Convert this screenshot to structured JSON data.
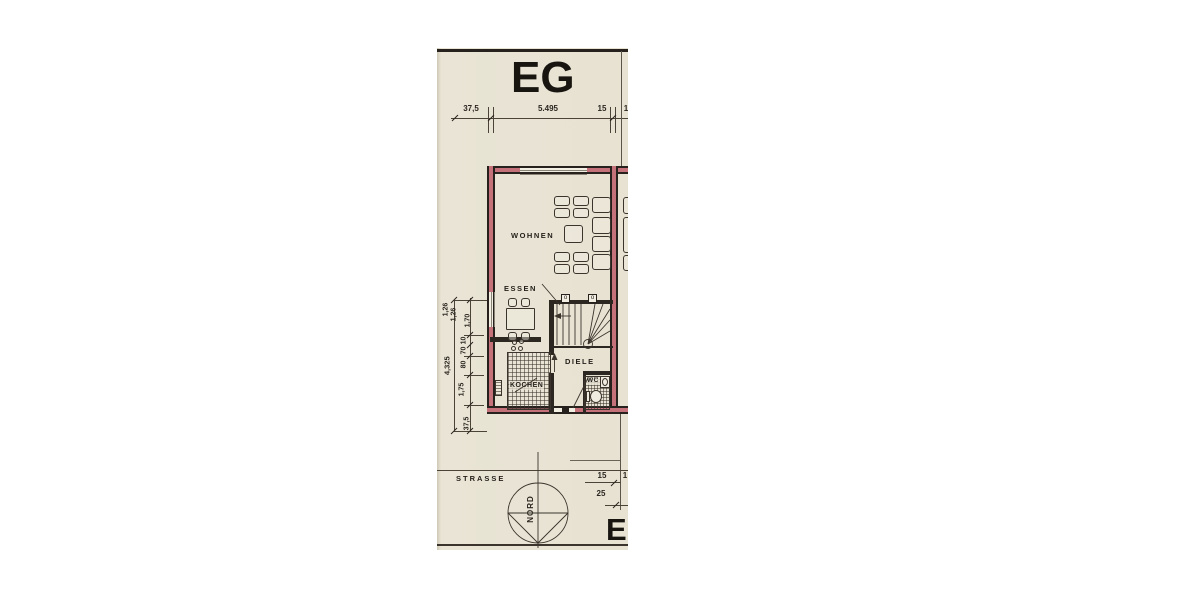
{
  "sheet": {
    "title": "EG",
    "next_sheet_title_partial": "EI"
  },
  "rooms": {
    "living": "WOHNEN",
    "dining": "ESSEN",
    "kitchen": "KOCHEN",
    "hall": "DIELE",
    "wc": "WC"
  },
  "site": {
    "street_label": "STRASSE",
    "north_label": "NORD"
  },
  "dimensions": {
    "top": [
      "37,5",
      "5.495",
      "15",
      "1"
    ],
    "left_chain": [
      "1,26",
      "1,26",
      "1,70",
      "10",
      "70",
      "80",
      "1,75",
      "37,5"
    ],
    "left_total": "4,325",
    "bottom_right_upper": "15",
    "bottom_right_upper_partial": "1",
    "bottom_right_lower": "25"
  },
  "markers": {
    "stair_pivot_left": "o",
    "stair_pivot_right": "o"
  },
  "colors": {
    "paper": "#e8e3d4",
    "wall_fill": "#c4717a",
    "ink": "#26211c"
  }
}
